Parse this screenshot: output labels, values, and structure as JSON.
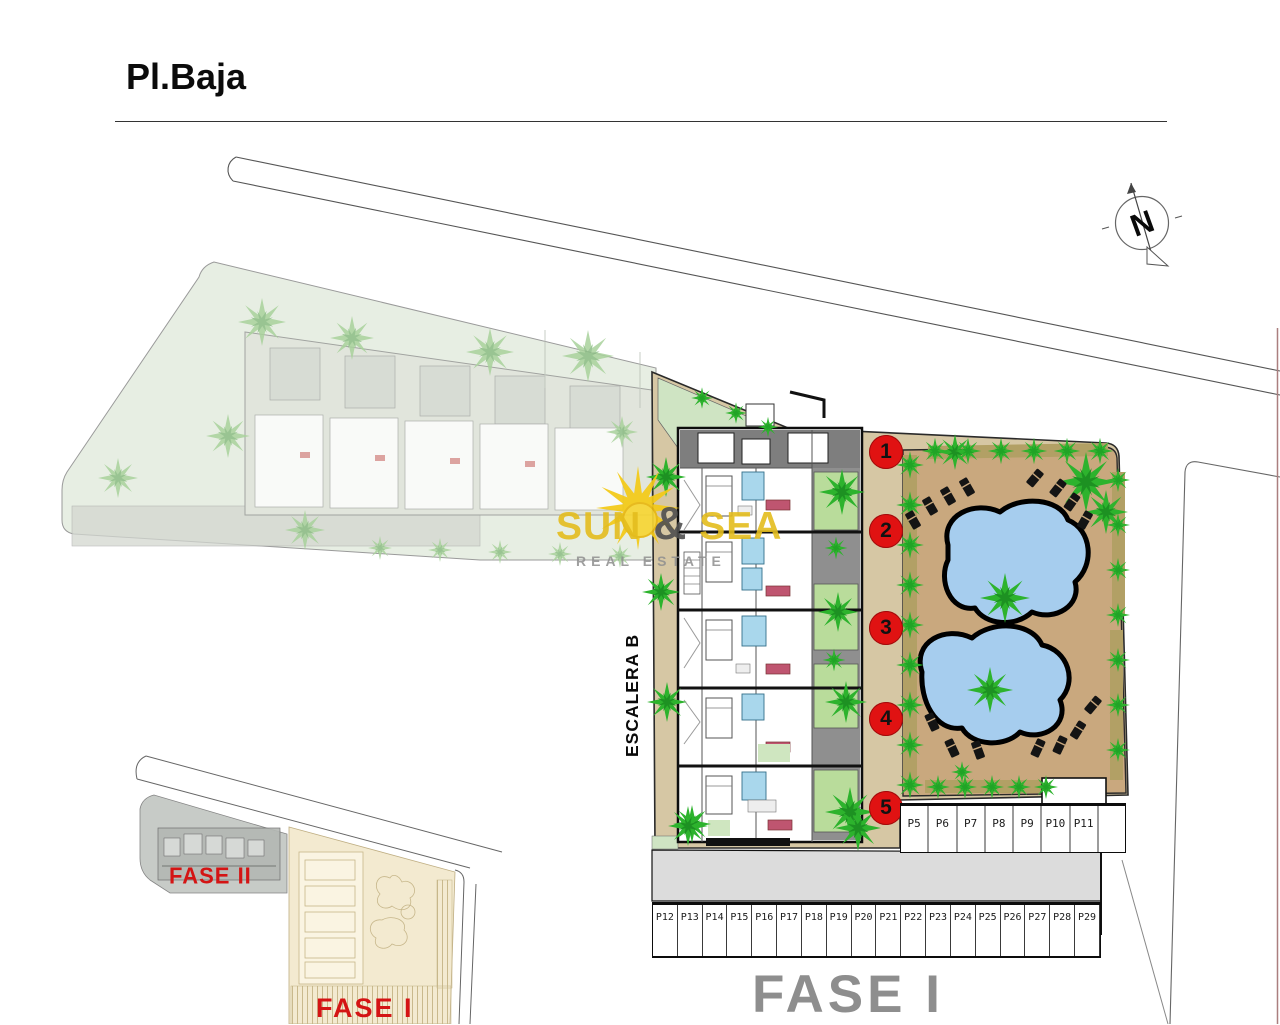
{
  "page": {
    "title": "Pl.Baja"
  },
  "compass": {
    "letter": "N"
  },
  "plan": {
    "stair_label": "ESCALERA B",
    "phase_label": "FASE I",
    "unit_markers": [
      "1",
      "2",
      "3",
      "4",
      "5"
    ]
  },
  "parking": {
    "row_upper": [
      "P5",
      "P6",
      "P7",
      "P8",
      "P9",
      "P10",
      "P11"
    ],
    "row_lower": [
      "P12",
      "P13",
      "P14",
      "P15",
      "P16",
      "P17",
      "P18",
      "P19",
      "P20",
      "P21",
      "P22",
      "P23",
      "P24",
      "P25",
      "P26",
      "P27",
      "P28",
      "P29"
    ]
  },
  "minimap": {
    "fase2_label": "FASE II",
    "fase1_label": "FASE I"
  },
  "watermark": {
    "word1": "SUN",
    "amp": "&",
    "word2": "SEA",
    "tagline": "REAL ESTATE"
  },
  "colors": {
    "marker_red": "#e01212",
    "phase_red": "#d41414",
    "phase_gray": "#8e8e8e",
    "site_tan": "#d6c7a4",
    "pool_ground": "#c9a87e",
    "pool_water": "#a6cdee",
    "garden_green": "#b9dc9b",
    "tree_green": "#2db32d",
    "faded_parcel_green": "#e7eee3",
    "road_gray": "#dcdcdc",
    "watermark_gold": "#e4bd1e"
  }
}
